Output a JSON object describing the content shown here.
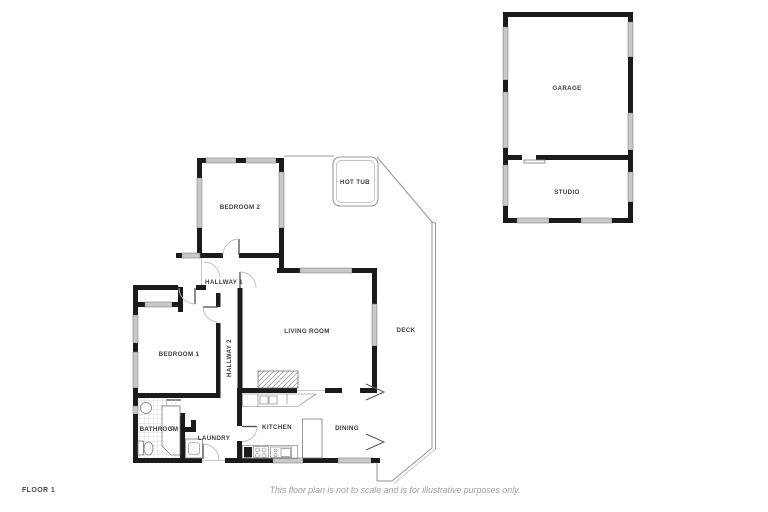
{
  "meta": {
    "floor_label": "FLOOR 1",
    "disclaimer": "This floor plan is not to scale and is for illustrative purposes only."
  },
  "colors": {
    "background": "#ffffff",
    "wall": "#1b1b1b",
    "window_fill": "#c9c9c9",
    "window_stroke": "#6f6f6f",
    "thin_line": "#9a9a9a",
    "door_arc": "#bdbdbd",
    "door_leaf": "#4f4f4f",
    "label": "#3c3c3c",
    "footer_text": "#9e9e9e",
    "floor_label_text": "#4a4a4a"
  },
  "rooms": [
    {
      "id": "garage",
      "label": "GARAGE",
      "x": 567,
      "y": 90,
      "rotate": 0
    },
    {
      "id": "studio",
      "label": "STUDIO",
      "x": 567,
      "y": 194,
      "rotate": 0
    },
    {
      "id": "bedroom-2",
      "label": "BEDROOM 2",
      "x": 240,
      "y": 209,
      "rotate": 0
    },
    {
      "id": "hot-tub",
      "label": "HOT TUB",
      "x": 355,
      "y": 184,
      "rotate": 0
    },
    {
      "id": "hallway-1",
      "label": "HALLWAY 1",
      "x": 224,
      "y": 284,
      "rotate": 0
    },
    {
      "id": "living-room",
      "label": "LIVING ROOM",
      "x": 307,
      "y": 333,
      "rotate": 0
    },
    {
      "id": "deck",
      "label": "DECK",
      "x": 406,
      "y": 332,
      "rotate": 0
    },
    {
      "id": "bedroom-1",
      "label": "BEDROOM 1",
      "x": 179,
      "y": 356,
      "rotate": 0
    },
    {
      "id": "hallway-2",
      "label": "HALLWAY 2",
      "x": 231,
      "y": 358,
      "rotate": -90
    },
    {
      "id": "bathroom",
      "label": "BATHROOM",
      "x": 159,
      "y": 431,
      "rotate": 0
    },
    {
      "id": "laundry",
      "label": "LAUNDRY",
      "x": 214,
      "y": 440,
      "rotate": 0
    },
    {
      "id": "kitchen",
      "label": "KITCHEN",
      "x": 277,
      "y": 429,
      "rotate": 0
    },
    {
      "id": "dining",
      "label": "DINING",
      "x": 347,
      "y": 430,
      "rotate": 0
    }
  ]
}
